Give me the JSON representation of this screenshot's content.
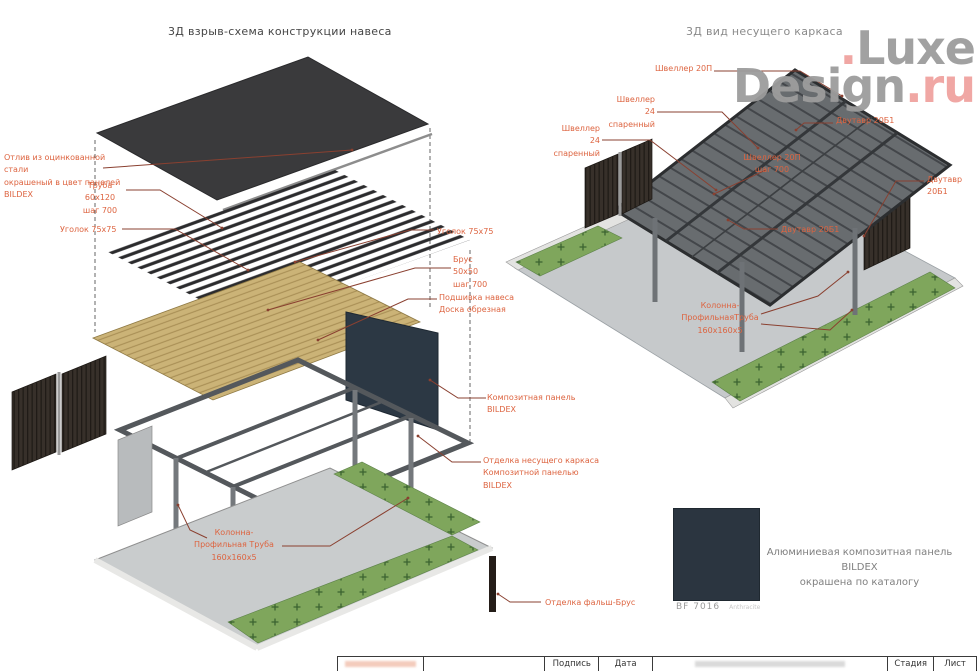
{
  "logo": {
    "dot": ".",
    "word1": "Luxe",
    "word2": "Design",
    "suffix": ".ru"
  },
  "views": {
    "left_title": "3Д взрыв-схема конструкции навеса",
    "right_title": "3Д вид несущего каркаса"
  },
  "left_labels": [
    {
      "id": "otliv",
      "text": "Отлив из оцинкованной стали\nокрашеный в цвет панелей\nBILDEX"
    },
    {
      "id": "truba",
      "text": "Труба 60x120\nшаг 700"
    },
    {
      "id": "ugolok-left",
      "text": "Уголок 75x75"
    },
    {
      "id": "ugolok-right",
      "text": "Уголок 75x75"
    },
    {
      "id": "brus",
      "text": "Брус\n50x50\nшаг 700"
    },
    {
      "id": "podshivka",
      "text": "Подшивка навеса\nДоска обрезная"
    },
    {
      "id": "kompozit",
      "text": "Композитная панель\nBILDEX"
    },
    {
      "id": "otdelka",
      "text": "Отделка несущего каркаса\nКомпозитной панелью\nBILDEX"
    },
    {
      "id": "kolonna",
      "text": "Колонна-\nПрофильная Труба\n160x160x5"
    },
    {
      "id": "falsh-brus",
      "text": "Отделка фальш-Брус"
    }
  ],
  "right_labels": [
    {
      "id": "shveller-20p",
      "text": "Швеллер 20П"
    },
    {
      "id": "shveller-24-a",
      "text": "Швеллер 24\nспаренный"
    },
    {
      "id": "shveller-24-b",
      "text": "Швеллер 24\nспаренный"
    },
    {
      "id": "dvutavr-1",
      "text": "Двутавр 20Б1"
    },
    {
      "id": "dvutavr-2",
      "text": "Двутавр 20Б1"
    },
    {
      "id": "shveller-shag",
      "text": "Швеллер 20П\nшаг 700"
    },
    {
      "id": "dvutavr-3",
      "text": "Двутавр 20Б1"
    },
    {
      "id": "kolonna-2",
      "text": "Колонна-\nПрофильнаяТруба\n160x160x5"
    }
  ],
  "swatch": {
    "code": "BF 7016",
    "code_note": "Anthracite",
    "description": "Алюминиевая композитная панель BILDEX\nокрашена по каталогу",
    "color": "#2b3540"
  },
  "titleblock": {
    "signature": "Подпись",
    "date": "Дата",
    "stage": "Стадия",
    "sheet": "Лист"
  },
  "colors": {
    "annotation": "#dd6440",
    "leader": "#8a4030",
    "roof_dark": "#3a3a3c",
    "wood": "#cbb377",
    "steel": "#54585c",
    "grass": "#7fa65c",
    "panel_navy": "#2c3844"
  }
}
